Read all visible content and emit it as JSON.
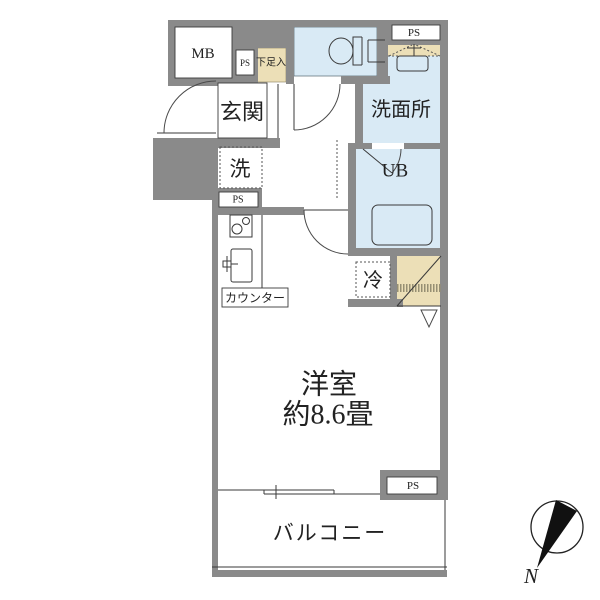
{
  "floorplan": {
    "labels": {
      "meter_box": "MB",
      "pipe_space": "PS",
      "shoe_cabinet": "下足入",
      "entrance": "玄関",
      "washroom": "洗面所",
      "washer_space": "洗",
      "unit_bath": "UB",
      "refrigerator": "冷",
      "counter": "カウンター",
      "main_room_name": "洋室",
      "main_room_size": "約8.6畳",
      "balcony": "バルコニー",
      "north": "N"
    },
    "colors": {
      "wall": "#8a8a8a",
      "wet_area": "#d9eaf5",
      "storage": "#ecdfb7",
      "background": "#ffffff",
      "line": "#3a3a3a"
    }
  }
}
